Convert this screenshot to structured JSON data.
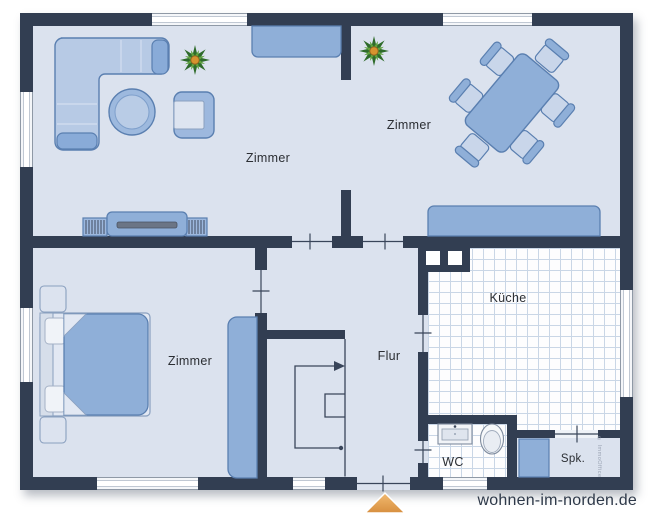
{
  "plan": {
    "rooms": [
      {
        "id": "living",
        "label": "Zimmer"
      },
      {
        "id": "dining",
        "label": "Zimmer"
      },
      {
        "id": "bedroom",
        "label": "Zimmer"
      },
      {
        "id": "hall",
        "label": "Flur"
      },
      {
        "id": "kitchen",
        "label": "Küche"
      },
      {
        "id": "wc",
        "label": "WC"
      },
      {
        "id": "pantry",
        "label": "Spk."
      }
    ],
    "symbols": [
      "corner-sofa",
      "coffee-table",
      "armchair",
      "tv-lowboard",
      "plant",
      "sideboard",
      "dining-table-6-chairs",
      "double-bed",
      "nightstands",
      "wardrobe",
      "staircase",
      "kitchen-chimney",
      "washbasin",
      "toilet",
      "pantry-cabinet",
      "entrance-arrow"
    ]
  },
  "branding": {
    "watermark": "wohnen-im-norden.de",
    "side_watermark": "© ImmoOffice"
  },
  "colors": {
    "wall": "#323e52",
    "floor": "#dbe2ee",
    "furniture_blue": "#8fafd8",
    "furniture_stroke": "#5a7fb0",
    "tile_line": "#c9d6e6",
    "entrance_arrow": "#e4a055",
    "plant_green": "#3f7d2e",
    "watermark_text": "#2e3949"
  }
}
